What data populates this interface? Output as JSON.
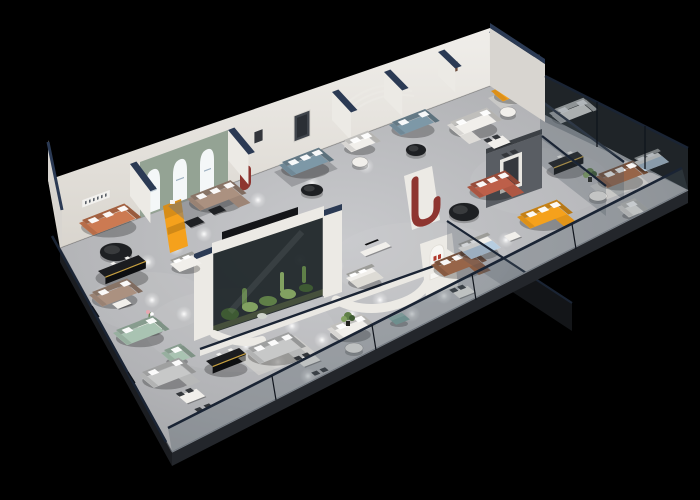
{
  "scene": {
    "description": "3D isometric cutaway render of a furniture showroom floor plan on a black background, with glass facade, many sofa display vignettes, a central glass plant terrarium, arched display wall and spot-lit gray floor"
  },
  "palette": {
    "bg": "#000000",
    "floor_base": "#b2b3b6",
    "floor_light": "#c9cacd",
    "wall_white": "#eceae5",
    "wall_shade": "#d8d5d0",
    "wall_dark": "#b7b4ae",
    "navy_cap": "#2b3a54",
    "rail_navy": "#1a2434",
    "glass_tint": "#4a5560",
    "glass_dark": "#242b33",
    "slab_edge": "#23262b",
    "slab_line": "#82878e",
    "sage_wall": "#94a394",
    "arch_glow": "#f4f7f8",
    "accent_orange": "#f5a11c",
    "sofa_terracotta": "#cc7a52",
    "sofa_tan": "#ab9180",
    "sofa_blue": "#7d98a7",
    "sofa_brown": "#976549",
    "sofa_coral": "#bd5f49",
    "sofa_white": "#f1efeb",
    "sofa_gray": "#c7c8c8",
    "sofa_green": "#a9c3b2",
    "bed_blue": "#b7cde0",
    "ottoman_teal": "#7fa8a2",
    "table_black": "#1e2023",
    "gold_trim": "#c7a040",
    "rug_light": "#dddbd5",
    "rug_dark": "#75787c",
    "plant_green": "#5f7f48",
    "plant_light": "#82a161",
    "plant_dark": "#3e5a33",
    "feature_gray": "#595d63",
    "feature_red": "#8e3530",
    "figure_dark": "#232c38"
  },
  "architecture": {
    "partitions": [
      {
        "name": "partition-wall-1",
        "x": 130,
        "y": 164,
        "d": 34,
        "vx": 0.6,
        "vy": 0.8,
        "h": 32
      },
      {
        "name": "partition-wall-2",
        "x": 228,
        "y": 130,
        "d": 32,
        "vx": 0.64,
        "vy": 0.77,
        "h": 30
      },
      {
        "name": "partition-wall-3",
        "x": 332,
        "y": 92,
        "d": 28,
        "vx": 0.68,
        "vy": 0.73,
        "h": 28
      },
      {
        "name": "partition-wall-4",
        "x": 384,
        "y": 72,
        "d": 26,
        "vx": 0.7,
        "vy": 0.71,
        "h": 26
      },
      {
        "name": "partition-wall-5",
        "x": 438,
        "y": 52,
        "d": 24,
        "vx": 0.72,
        "vy": 0.69,
        "h": 24
      },
      {
        "name": "partition-wall-6",
        "x": 489,
        "y": 32,
        "d": 24,
        "vx": 0.74,
        "vy": 0.67,
        "h": 24
      }
    ],
    "spotlights": [
      [
        148,
        262
      ],
      [
        176,
        248
      ],
      [
        204,
        234
      ],
      [
        152,
        300
      ],
      [
        184,
        314
      ],
      [
        214,
        330
      ],
      [
        246,
        346
      ],
      [
        278,
        362
      ],
      [
        308,
        376
      ],
      [
        262,
        312
      ],
      [
        292,
        326
      ],
      [
        322,
        340
      ],
      [
        352,
        314
      ],
      [
        380,
        300
      ],
      [
        300,
        260
      ],
      [
        336,
        266
      ],
      [
        412,
        314
      ],
      [
        444,
        296
      ],
      [
        476,
        256
      ],
      [
        506,
        240
      ],
      [
        258,
        200
      ],
      [
        312,
        184
      ],
      [
        366,
        166
      ],
      [
        420,
        150
      ],
      [
        468,
        134
      ]
    ]
  },
  "furniture": [
    {
      "name": "terracotta-striped-sofa",
      "type": "sofa",
      "color": "sofa_terracotta",
      "x": 82,
      "y": 226,
      "l": 46,
      "d": 15,
      "pillows": 3
    },
    {
      "name": "black-round-coffee-table",
      "type": "tableRound",
      "color": "table_black",
      "x": 116,
      "y": 252,
      "rx": 16,
      "ry": 9
    },
    {
      "name": "rug-arch-room",
      "type": "rug",
      "color": "rug_dark",
      "x": 168,
      "y": 206,
      "l": 56,
      "d": 26
    },
    {
      "name": "tan-corner-sofa",
      "type": "sofa",
      "color": "sofa_tan",
      "x": 190,
      "y": 202,
      "l": 44,
      "d": 14,
      "chaise": "right",
      "pillows": 3
    },
    {
      "name": "display-table-a",
      "type": "tableRect",
      "color": "table_black",
      "x": 184,
      "y": 226,
      "l": 15,
      "d": 9
    },
    {
      "name": "display-table-b",
      "type": "tableRect",
      "color": "table_black",
      "x": 208,
      "y": 214,
      "l": 13,
      "d": 8
    },
    {
      "name": "rug-blue-room",
      "type": "rug",
      "color": "rug_dark",
      "x": 274,
      "y": 172,
      "l": 50,
      "d": 24
    },
    {
      "name": "blue-fabric-sofa",
      "type": "sofa",
      "color": "sofa_blue",
      "x": 282,
      "y": 168,
      "l": 40,
      "d": 13,
      "pillows": 3
    },
    {
      "name": "black-round-table-2",
      "type": "tableRound",
      "color": "table_black",
      "x": 312,
      "y": 190,
      "rx": 11,
      "ry": 6
    },
    {
      "name": "white-booth-bench",
      "type": "sofa",
      "color": "sofa_white",
      "x": 344,
      "y": 146,
      "l": 26,
      "d": 10,
      "pillows": 2
    },
    {
      "name": "booth-table",
      "type": "tableRound",
      "color": "sofa_white",
      "x": 360,
      "y": 162,
      "rx": 8,
      "ry": 5
    },
    {
      "name": "blue-fabric-sofa-2",
      "type": "sofa",
      "color": "sofa_blue",
      "x": 392,
      "y": 128,
      "l": 36,
      "d": 12,
      "pillows": 2
    },
    {
      "name": "black-round-table-3",
      "type": "tableRound",
      "color": "table_black",
      "x": 416,
      "y": 150,
      "rx": 10,
      "ry": 6
    },
    {
      "name": "white-corner-sofa",
      "type": "sofa",
      "color": "sofa_white",
      "x": 450,
      "y": 128,
      "l": 40,
      "d": 13,
      "chaise": "left",
      "pillows": 2
    },
    {
      "name": "dining-set-white-room",
      "type": "tableRect",
      "color": "sofa_white",
      "x": 486,
      "y": 146,
      "l": 18,
      "d": 11,
      "chairs": true
    },
    {
      "name": "rug-reception",
      "type": "rug",
      "color": "rug_light",
      "x": 488,
      "y": 98,
      "l": 40,
      "d": 18
    },
    {
      "name": "orange-sofa-reception",
      "type": "sofa",
      "color": "accent_orange",
      "x": 494,
      "y": 94,
      "l": 32,
      "d": 12,
      "pillows": 2
    },
    {
      "name": "reception-side-table",
      "type": "tableRound",
      "color": "sofa_white",
      "x": 508,
      "y": 112,
      "rx": 8,
      "ry": 5
    },
    {
      "name": "white-sofa-glass-room",
      "type": "sofa",
      "color": "sofa_white",
      "x": 552,
      "y": 116,
      "l": 34,
      "d": 12,
      "pillows": 2
    },
    {
      "name": "rug-brown-room",
      "type": "rug",
      "color": "rug_light",
      "x": 590,
      "y": 186,
      "l": 46,
      "d": 22
    },
    {
      "name": "brown-leather-sofa",
      "type": "sofa",
      "color": "sofa_brown",
      "x": 598,
      "y": 180,
      "l": 38,
      "d": 13,
      "pillows": 3
    },
    {
      "name": "white-armchair",
      "type": "sofa",
      "color": "sofa_white",
      "x": 620,
      "y": 210,
      "l": 16,
      "d": 12,
      "pillows": 1
    },
    {
      "name": "white-round-table",
      "type": "tableRound",
      "color": "sofa_white",
      "x": 598,
      "y": 196,
      "rx": 9,
      "ry": 5
    },
    {
      "name": "potted-plant-right",
      "type": "plant",
      "x": 590,
      "y": 180
    },
    {
      "name": "bed-right-room",
      "type": "bed",
      "color": "bed_blue",
      "x": 634,
      "y": 162,
      "l": 26,
      "d": 15
    },
    {
      "name": "coral-chaise-sofa",
      "type": "sofa",
      "color": "sofa_coral",
      "x": 470,
      "y": 190,
      "l": 38,
      "d": 13,
      "chaise": "right",
      "pillows": 3
    },
    {
      "name": "black-oval-coffee-table",
      "type": "tableRound",
      "color": "table_black",
      "x": 464,
      "y": 212,
      "rx": 15,
      "ry": 9
    },
    {
      "name": "orange-corner-sofa",
      "type": "sofa",
      "color": "accent_orange",
      "x": 520,
      "y": 220,
      "l": 40,
      "d": 14,
      "chaise": "right",
      "pillows": 3
    },
    {
      "name": "writing-desk",
      "type": "tableRect",
      "color": "sofa_white",
      "x": 504,
      "y": 240,
      "l": 12,
      "d": 8
    },
    {
      "name": "slatted-media-bench",
      "type": "console",
      "color": "table_black",
      "x": 548,
      "y": 170,
      "l": 32,
      "d": 8
    },
    {
      "name": "brown-sectional-sofa",
      "type": "sofa",
      "color": "sofa_brown",
      "x": 434,
      "y": 268,
      "l": 40,
      "d": 14,
      "chaise": "right",
      "pillows": 3
    },
    {
      "name": "dining-set-center",
      "type": "tableRect",
      "color": "sofa_white",
      "x": 452,
      "y": 296,
      "l": 17,
      "d": 10,
      "chairs": true
    },
    {
      "name": "bed-display-blue",
      "type": "bed",
      "color": "bed_blue",
      "x": 458,
      "y": 248,
      "l": 32,
      "d": 18
    },
    {
      "name": "bed-display-gray",
      "type": "bed",
      "color": "rug_light",
      "x": 346,
      "y": 278,
      "l": 28,
      "d": 16
    },
    {
      "name": "tv-media-console",
      "type": "tableRect",
      "color": "sofa_white",
      "x": 360,
      "y": 256,
      "l": 28,
      "d": 7,
      "tv": true
    },
    {
      "name": "white-daybed",
      "type": "bed",
      "color": "sofa_white",
      "x": 170,
      "y": 264,
      "l": 24,
      "d": 13
    },
    {
      "name": "black-gold-console",
      "type": "console",
      "color": "table_black",
      "x": 98,
      "y": 278,
      "l": 44,
      "d": 10
    },
    {
      "name": "taupe-sofa",
      "type": "sofa",
      "color": "sofa_tan",
      "x": 92,
      "y": 298,
      "l": 38,
      "d": 14,
      "pillows": 2
    },
    {
      "name": "white-coffee-table",
      "type": "tableRect",
      "color": "sofa_white",
      "x": 112,
      "y": 308,
      "l": 15,
      "d": 8
    },
    {
      "name": "round-dining-table-flowers",
      "type": "tableRound",
      "color": "sofa_white",
      "x": 150,
      "y": 326,
      "rx": 13,
      "ry": 8,
      "flower": true
    },
    {
      "name": "dark-dining-chair",
      "type": "tableRect",
      "color": "table_black",
      "x": 136,
      "y": 336,
      "l": 7,
      "d": 6
    },
    {
      "name": "sage-green-sofa",
      "type": "sofa",
      "color": "sofa_green",
      "x": 116,
      "y": 336,
      "l": 40,
      "d": 15,
      "pillows": 2
    },
    {
      "name": "sage-green-armchair",
      "type": "sofa",
      "color": "sofa_green",
      "x": 164,
      "y": 356,
      "l": 18,
      "d": 13,
      "pillows": 1
    },
    {
      "name": "gray-chaise-sofa",
      "type": "sofa",
      "color": "sofa_gray",
      "x": 142,
      "y": 378,
      "l": 40,
      "d": 16,
      "chaise": "right",
      "pillows": 2
    },
    {
      "name": "dining-table-front",
      "type": "tableRect",
      "color": "sofa_white",
      "x": 178,
      "y": 400,
      "l": 20,
      "d": 12,
      "chairs": true
    },
    {
      "name": "black-gold-console-2",
      "type": "console",
      "color": "table_black",
      "x": 206,
      "y": 368,
      "l": 36,
      "d": 9
    },
    {
      "name": "rug-front-middle",
      "type": "rug",
      "color": "rug_light",
      "x": 238,
      "y": 358,
      "l": 62,
      "d": 28
    },
    {
      "name": "light-gray-sectional",
      "type": "sofa",
      "color": "sofa_gray",
      "x": 248,
      "y": 354,
      "l": 44,
      "d": 16,
      "chaise": "right",
      "pillows": 3
    },
    {
      "name": "dining-table-middle",
      "type": "tableRect",
      "color": "sofa_white",
      "x": 296,
      "y": 364,
      "l": 18,
      "d": 11,
      "chairs": true
    },
    {
      "name": "white-sofa-middle",
      "type": "sofa",
      "color": "sofa_white",
      "x": 330,
      "y": 332,
      "l": 34,
      "d": 13,
      "pillows": 2
    },
    {
      "name": "white-round-table-2",
      "type": "tableRound",
      "color": "sofa_white",
      "x": 354,
      "y": 348,
      "rx": 9,
      "ry": 5
    },
    {
      "name": "teal-ottoman",
      "type": "ottoman",
      "color": "ottoman_teal",
      "x": 388,
      "y": 318,
      "l": 15,
      "d": 11
    },
    {
      "name": "potted-plant-middle",
      "type": "plant",
      "x": 348,
      "y": 324
    }
  ]
}
